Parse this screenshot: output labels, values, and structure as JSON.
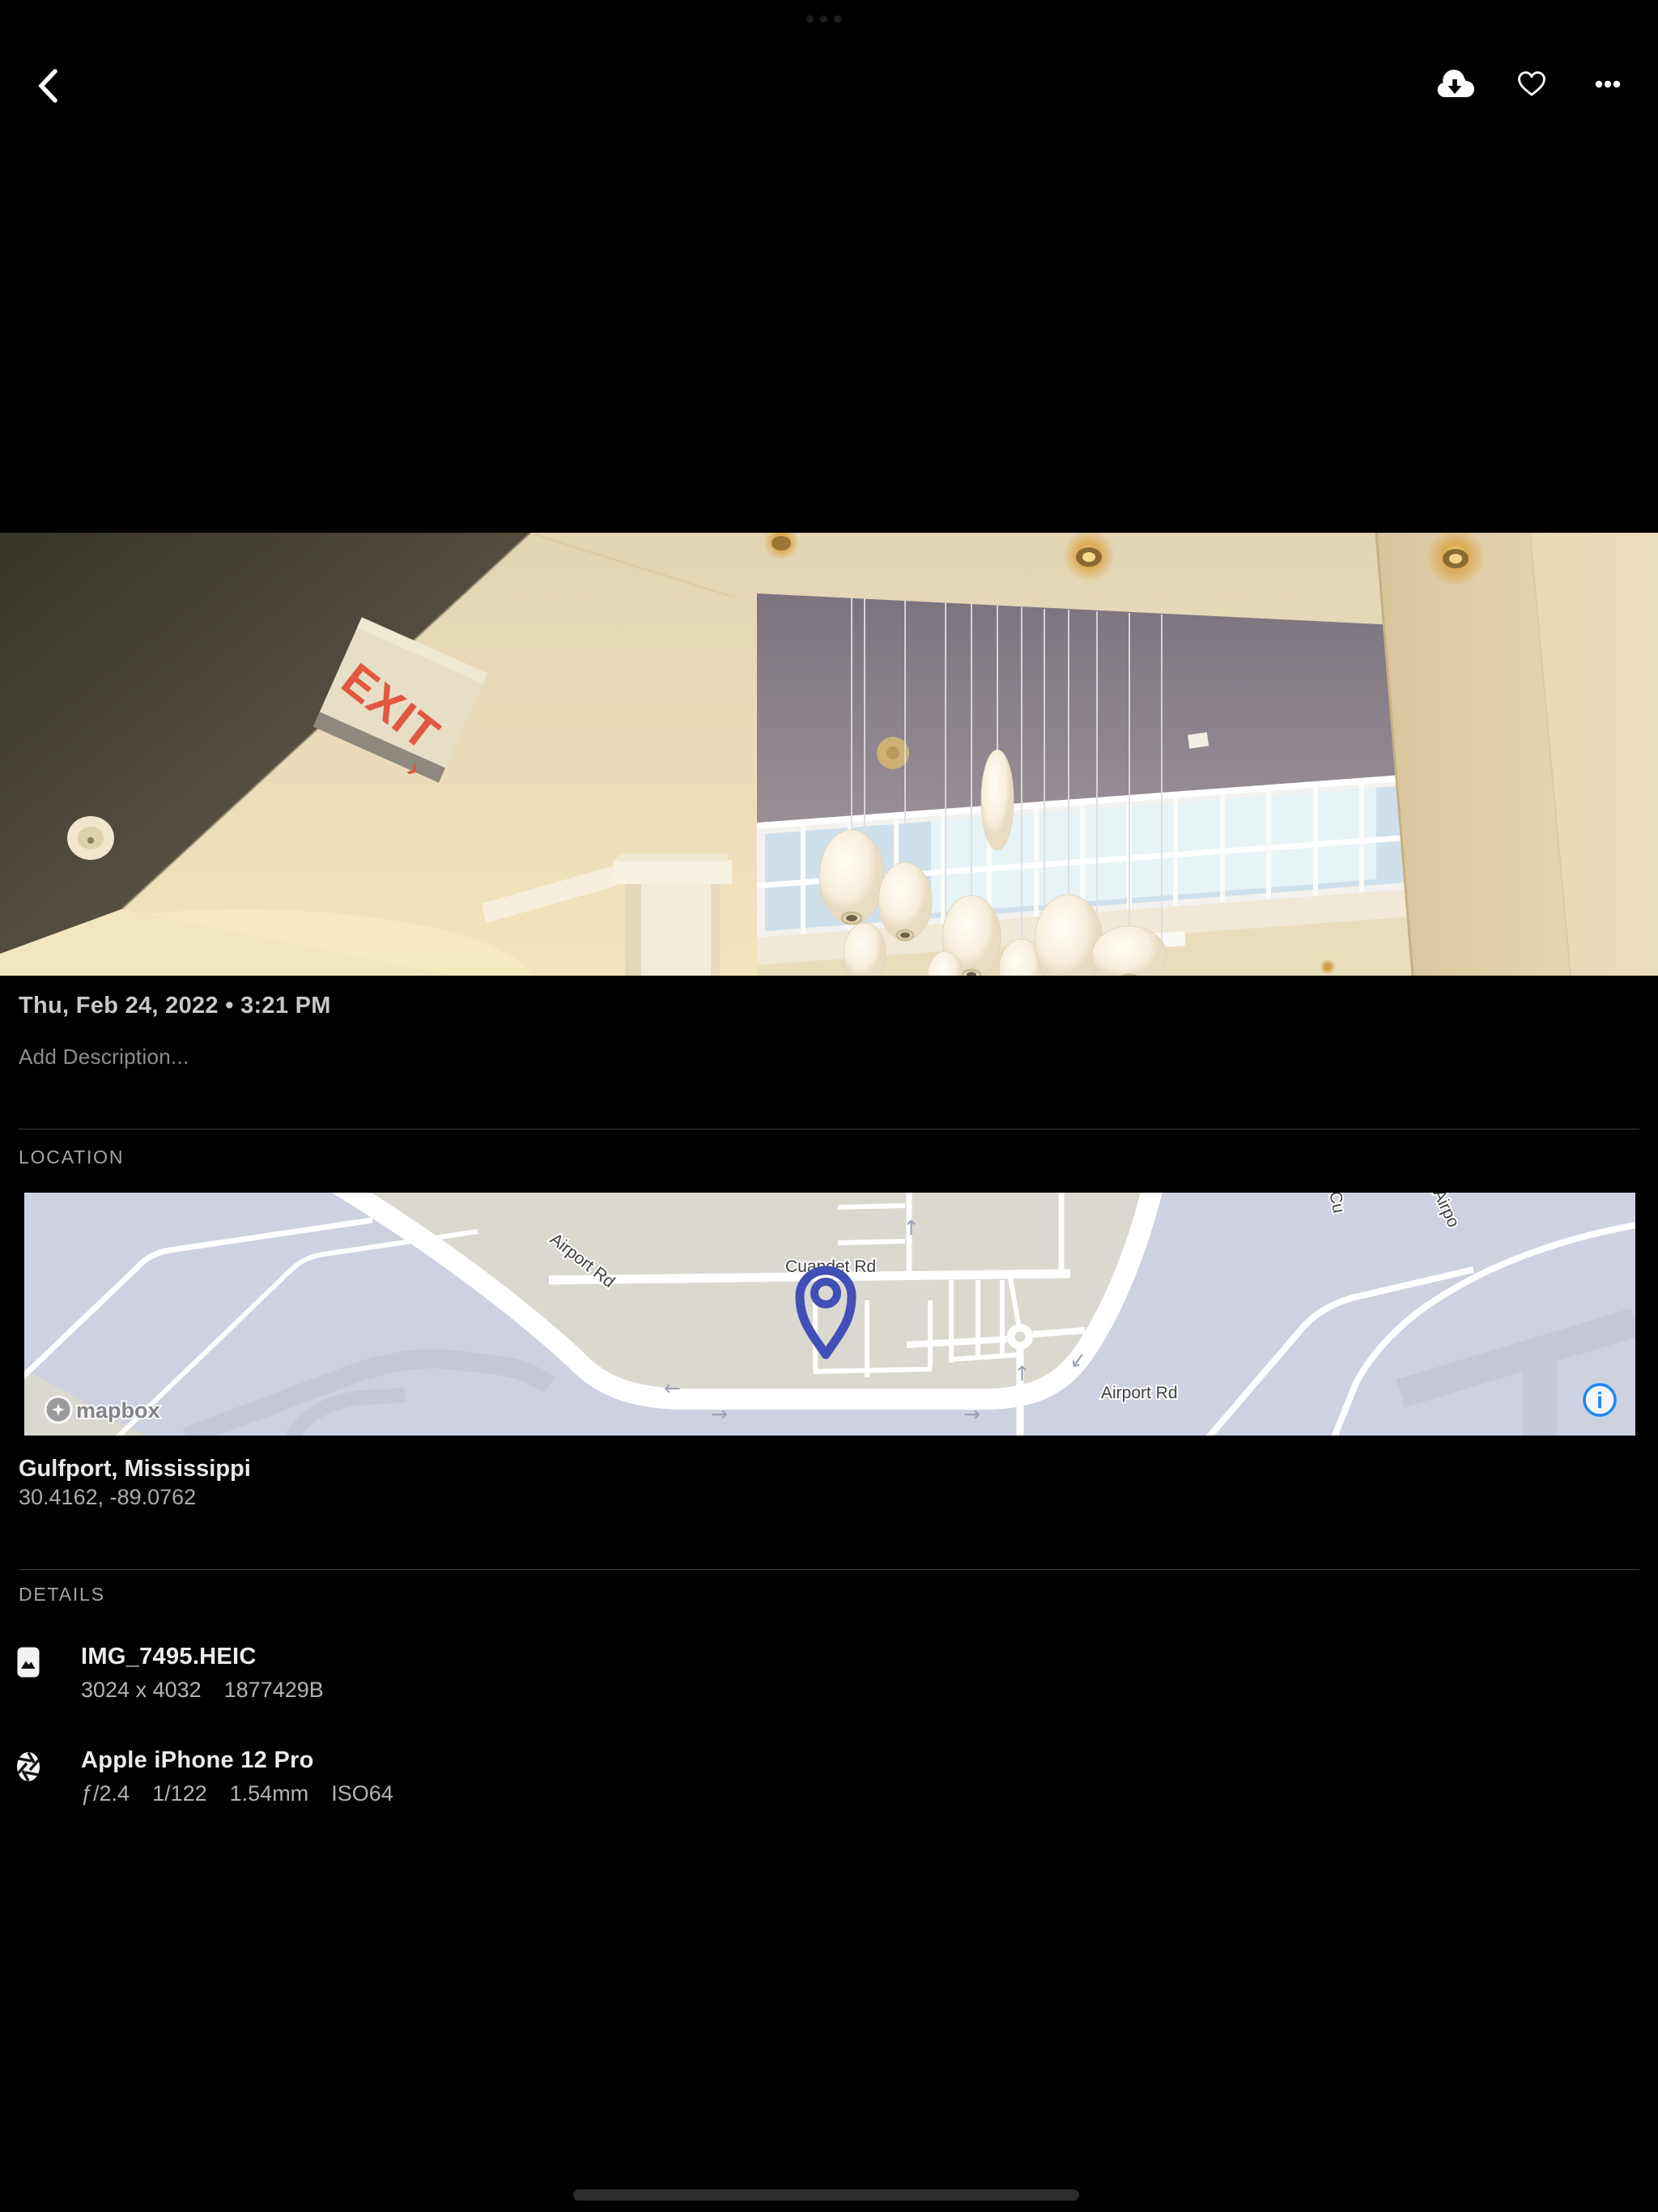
{
  "photo": {
    "exit_sign_text": "EXIT",
    "exit_arrow": "›"
  },
  "meta": {
    "datetime": "Thu, Feb 24, 2022 • 3:21 PM",
    "description_placeholder": "Add Description..."
  },
  "location": {
    "label": "LOCATION",
    "place": "Gulfport, Mississippi",
    "coordinates": "30.4162, -89.0762",
    "map": {
      "road_cuandet": "Cuandet Rd",
      "road_airport": "Airport Rd",
      "road_airport_partial": "Airpo",
      "road_c_partial": "Cu",
      "attribution": "mapbox",
      "info_glyph": "i",
      "arrow_left": "←",
      "arrow_right": "→",
      "arrow_up": "↑",
      "arrow_down": "↓",
      "colors": {
        "land_beige": "#dbd8d0",
        "land_lavender": "#cdd1e0",
        "road_dark_lavender": "#c3c7d8",
        "pin_indigo": "#4050b6",
        "info_blue": "#1e87f2"
      }
    }
  },
  "details": {
    "label": "DETAILS",
    "file": {
      "title": "IMG_7495.HEIC",
      "dimensions": "3024 x 4032",
      "size": "1877429B"
    },
    "camera": {
      "title": "Apple iPhone 12 Pro",
      "aperture": "ƒ/2.4",
      "shutter": "1/122",
      "focal": "1.54mm",
      "iso": "ISO64"
    }
  }
}
